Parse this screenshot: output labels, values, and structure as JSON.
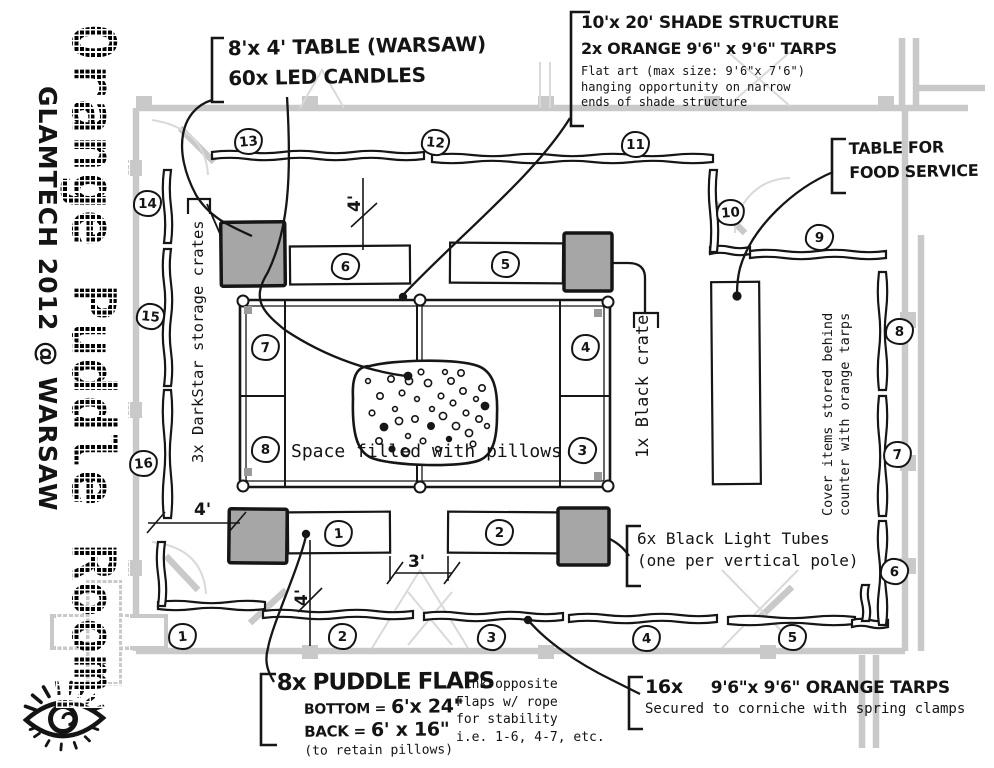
{
  "colors": {
    "ink": "#161616",
    "wall_gray": "#c9c9c9",
    "thin_gray": "#d9d9d9",
    "crate_gray": "#a6a6a6",
    "paper": "#ffffff"
  },
  "branding": {
    "room_title": "Orange Puddle Room",
    "event_title": "GLAMTECH 2012 @ WARSAW"
  },
  "callouts": {
    "table": {
      "line1": "8'x 4' TABLE (WARSAW)",
      "line2": "60x LED CANDLES"
    },
    "shade": {
      "line1": "10'x 20' SHADE STRUCTURE",
      "line2": "2x ORANGE  9'6\" x 9'6\" TARPS",
      "note1": "Flat art (max size: 9'6\"x 7'6\")",
      "note2": "hanging opportunity on narrow",
      "note3": "ends of shade structure"
    },
    "food": {
      "line1": "TABLE FOR",
      "line2": "FOOD SERVICE"
    },
    "blacklight": {
      "line1": "6x Black Light Tubes",
      "line2": "(one per vertical pole)"
    },
    "flaps": {
      "title": "8x PUDDLE FLAPS",
      "bottom_label": "BOTTOM =",
      "bottom_size": "6'x 24\"",
      "back_label": "BACK =",
      "back_size": "6' x 16\"",
      "note": "(to retain pillows)",
      "side1": "link opposite",
      "side2": "Flaps w/ rope",
      "side3": "for stability",
      "side4": "i.e. 1-6, 4-7, etc."
    },
    "tarps": {
      "count": "16x",
      "line1": "9'6\"x 9'6\" ORANGE TARPS",
      "line2": "Secured to corniche with spring clamps"
    }
  },
  "labels": {
    "darkstar": "3x DarkStar storage crates",
    "black_crate": "1x Black crate",
    "cover1": "Cover items stored behind",
    "cover2": "counter with orange tarps",
    "pillows": "Space filled with pillows"
  },
  "dimensions": {
    "shade_offset_top": "4'",
    "left_offset": "4'",
    "bottom_offset": "4'",
    "gap": "3'"
  },
  "plan": {
    "wall_numbers": [
      {
        "n": "1",
        "x": 181,
        "y": 635
      },
      {
        "n": "2",
        "x": 341,
        "y": 635
      },
      {
        "n": "3",
        "x": 490,
        "y": 636
      },
      {
        "n": "4",
        "x": 645,
        "y": 637
      },
      {
        "n": "5",
        "x": 791,
        "y": 636
      },
      {
        "n": "6",
        "x": 893,
        "y": 570
      },
      {
        "n": "7",
        "x": 896,
        "y": 453
      },
      {
        "n": "8",
        "x": 898,
        "y": 330
      },
      {
        "n": "9",
        "x": 818,
        "y": 236
      },
      {
        "n": "10",
        "x": 729,
        "y": 211
      },
      {
        "n": "11",
        "x": 634,
        "y": 143
      },
      {
        "n": "12",
        "x": 434,
        "y": 141
      },
      {
        "n": "13",
        "x": 247,
        "y": 140
      },
      {
        "n": "14",
        "x": 146,
        "y": 202
      },
      {
        "n": "15",
        "x": 149,
        "y": 315
      },
      {
        "n": "16",
        "x": 142,
        "y": 462
      }
    ],
    "pole_numbers": [
      {
        "n": "1",
        "x": 337,
        "y": 532
      },
      {
        "n": "2",
        "x": 498,
        "y": 531
      },
      {
        "n": "3",
        "x": 581,
        "y": 449
      },
      {
        "n": "4",
        "x": 584,
        "y": 346
      },
      {
        "n": "5",
        "x": 504,
        "y": 263
      },
      {
        "n": "6",
        "x": 344,
        "y": 265
      },
      {
        "n": "7",
        "x": 264,
        "y": 346
      },
      {
        "n": "8",
        "x": 264,
        "y": 448
      }
    ],
    "pillow_dots": [
      [
        368,
        381
      ],
      [
        380,
        396
      ],
      [
        372,
        413
      ],
      [
        384,
        427
      ],
      [
        395,
        409
      ],
      [
        391,
        379
      ],
      [
        402,
        393
      ],
      [
        399,
        421
      ],
      [
        408,
        436
      ],
      [
        379,
        441
      ],
      [
        392,
        449
      ],
      [
        406,
        452
      ],
      [
        417,
        399
      ],
      [
        415,
        419
      ],
      [
        423,
        441
      ],
      [
        428,
        383
      ],
      [
        432,
        409
      ],
      [
        431,
        426
      ],
      [
        441,
        396
      ],
      [
        443,
        416
      ],
      [
        438,
        449
      ],
      [
        451,
        381
      ],
      [
        453,
        403
      ],
      [
        456,
        426
      ],
      [
        449,
        439
      ],
      [
        463,
        391
      ],
      [
        466,
        413
      ],
      [
        469,
        433
      ],
      [
        476,
        399
      ],
      [
        479,
        419
      ],
      [
        473,
        444
      ],
      [
        485,
        406
      ],
      [
        487,
        426
      ],
      [
        461,
        373
      ],
      [
        421,
        372
      ],
      [
        409,
        381
      ],
      [
        445,
        372
      ],
      [
        482,
        388
      ]
    ]
  }
}
